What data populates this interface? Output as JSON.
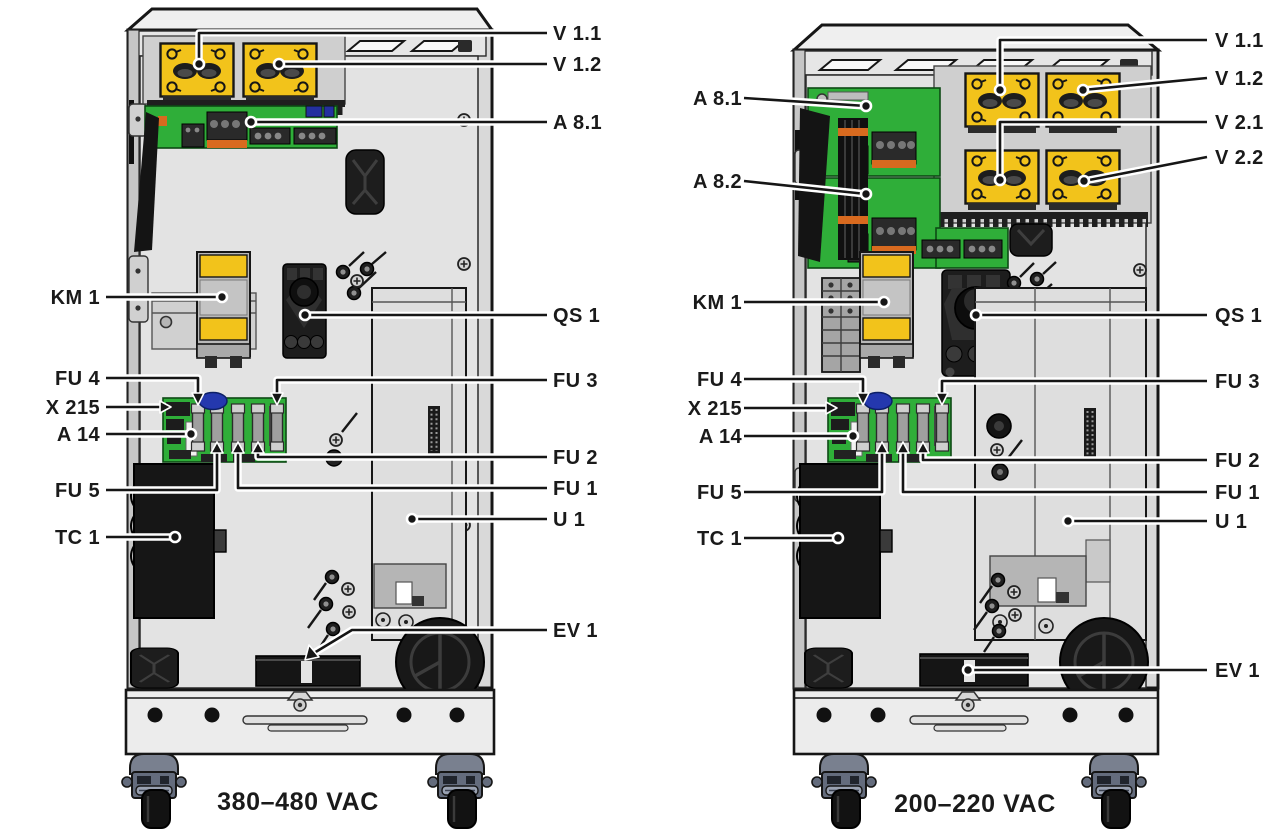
{
  "page": {
    "background": "#ffffff"
  },
  "colors": {
    "module_yellow": "#F2C31B",
    "pcb_green": "#2FAE39",
    "cap_blue": "#2438AE",
    "caster_slate": "#79808F",
    "line_dark": "#161616"
  },
  "left_unit": {
    "caption": "380–480 VAC",
    "labels": {
      "v1_1": "V 1.1",
      "v1_2": "V 1.2",
      "a8_1": "A 8.1",
      "km_1": "KM 1",
      "qs_1": "QS 1",
      "fu_4": "FU 4",
      "x_215": "X 215",
      "a_14": "A 14",
      "fu_3": "FU 3",
      "fu_2": "FU 2",
      "fu_1": "FU 1",
      "fu_5": "FU 5",
      "u_1": "U 1",
      "tc_1": "TC 1",
      "ev_1": "EV 1"
    }
  },
  "right_unit": {
    "caption": "200–220 VAC",
    "labels": {
      "v1_1": "V 1.1",
      "v1_2": "V 1.2",
      "v2_1": "V 2.1",
      "v2_2": "V 2.2",
      "a8_1": "A 8.1",
      "a8_2": "A 8.2",
      "km_1": "KM 1",
      "qs_1": "QS 1",
      "fu_4": "FU 4",
      "x_215": "X 215",
      "a_14": "A 14",
      "fu_3": "FU 3",
      "fu_2": "FU 2",
      "fu_1": "FU 1",
      "fu_5": "FU 5",
      "u_1": "U 1",
      "tc_1": "TC 1",
      "ev_1": "EV 1"
    }
  }
}
